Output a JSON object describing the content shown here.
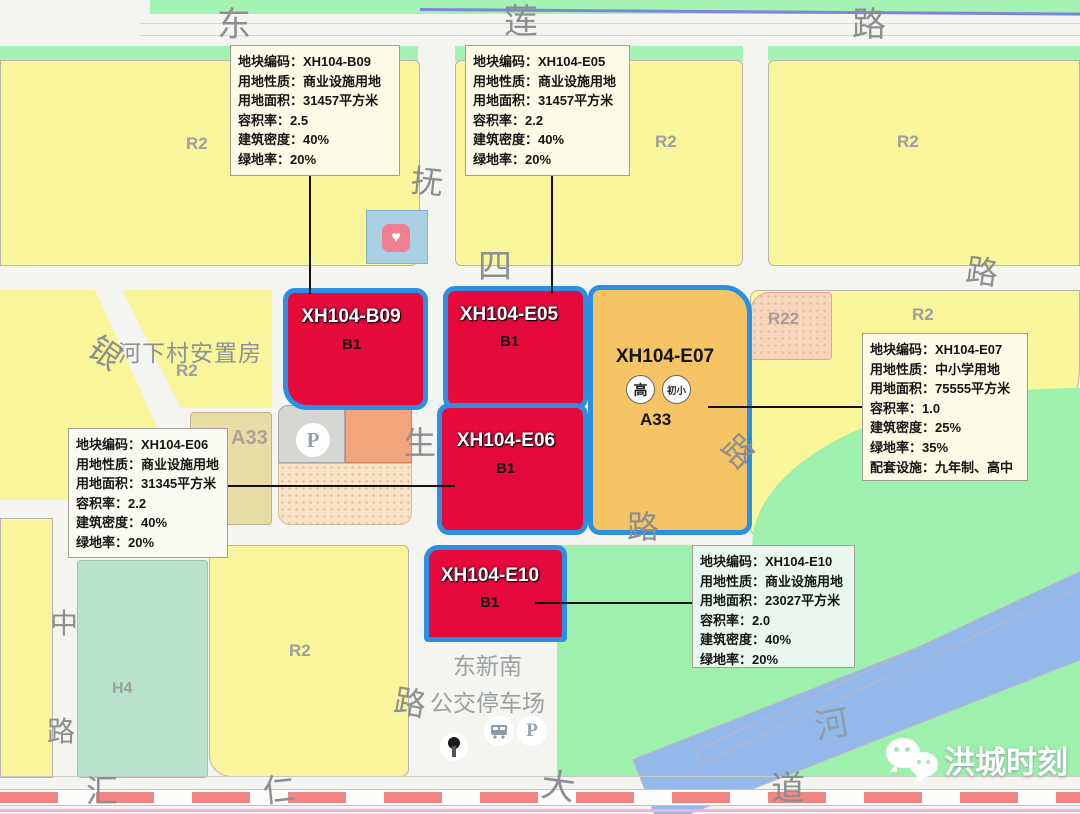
{
  "annotation_boxes": [
    {
      "id": "XH104-B09",
      "lines": [
        "地块编码：XH104-B09",
        "用地性质：商业设施用地",
        "用地面积：31457平方米",
        "容积率：2.5",
        "建筑密度：40%",
        "绿地率：20%"
      ]
    },
    {
      "id": "XH104-E05",
      "lines": [
        "地块编码：XH104-E05",
        "用地性质：商业设施用地",
        "用地面积：31457平方米",
        "容积率：2.2",
        "建筑密度：40%",
        "绿地率：20%"
      ]
    },
    {
      "id": "XH104-E07",
      "lines": [
        "地块编码：XH104-E07",
        "用地性质：中小学用地",
        "用地面积：75555平方米",
        "容积率：1.0",
        "建筑密度：25%",
        "绿地率：35%",
        "配套设施：九年制、高中"
      ]
    },
    {
      "id": "XH104-E06",
      "lines": [
        "地块编码：XH104-E06",
        "用地性质：商业设施用地",
        "用地面积：31345平方米",
        "容积率：2.2",
        "建筑密度：40%",
        "绿地率：20%"
      ]
    },
    {
      "id": "XH104-E10",
      "lines": [
        "地块编码：XH104-E10",
        "用地性质：商业设施用地",
        "用地面积：23027平方米",
        "容积率：2.0",
        "建筑密度：40%",
        "绿地率：20%"
      ]
    }
  ],
  "parcels": {
    "b09": {
      "code": "XH104-B09",
      "zone": "B1"
    },
    "e05": {
      "code": "XH104-E05",
      "zone": "B1"
    },
    "e06": {
      "code": "XH104-E06",
      "zone": "B1"
    },
    "e10": {
      "code": "XH104-E10",
      "zone": "B1"
    },
    "e07": {
      "code": "XH104-E07",
      "zone": "A33",
      "badge_high": "高",
      "badge_primary": "初小"
    }
  },
  "zone_labels": [
    "R2",
    "R2",
    "R2",
    "R2",
    "R2",
    "R2",
    "R22",
    "H4",
    "A33"
  ],
  "road_labels": [
    "东",
    "莲",
    "路",
    "四",
    "路",
    "抚",
    "生",
    "路",
    "银",
    "中",
    "路",
    "路",
    "路",
    "汇",
    "仁",
    "大",
    "道",
    "河"
  ],
  "place_labels": {
    "resettlement": "河下村安置房",
    "resettlement_zone": "R2",
    "bus_depot_line1": "东新南",
    "bus_depot_line2": "公交停车场"
  },
  "icons": {
    "parking": "P",
    "bus_parking": "P",
    "heart": "♥"
  },
  "watermark": {
    "text": "洪城时刻"
  },
  "colors": {
    "parcel_red": "#e60a3c",
    "parcel_orange": "#f5c464",
    "outline_blue": "#2d8fe2",
    "residential_yellow": "#f8f59b",
    "green_space": "#9df1ad",
    "river_blue": "#92b9e9",
    "railway_red": "#f28484",
    "annotation_bg": "#fdfae6"
  }
}
